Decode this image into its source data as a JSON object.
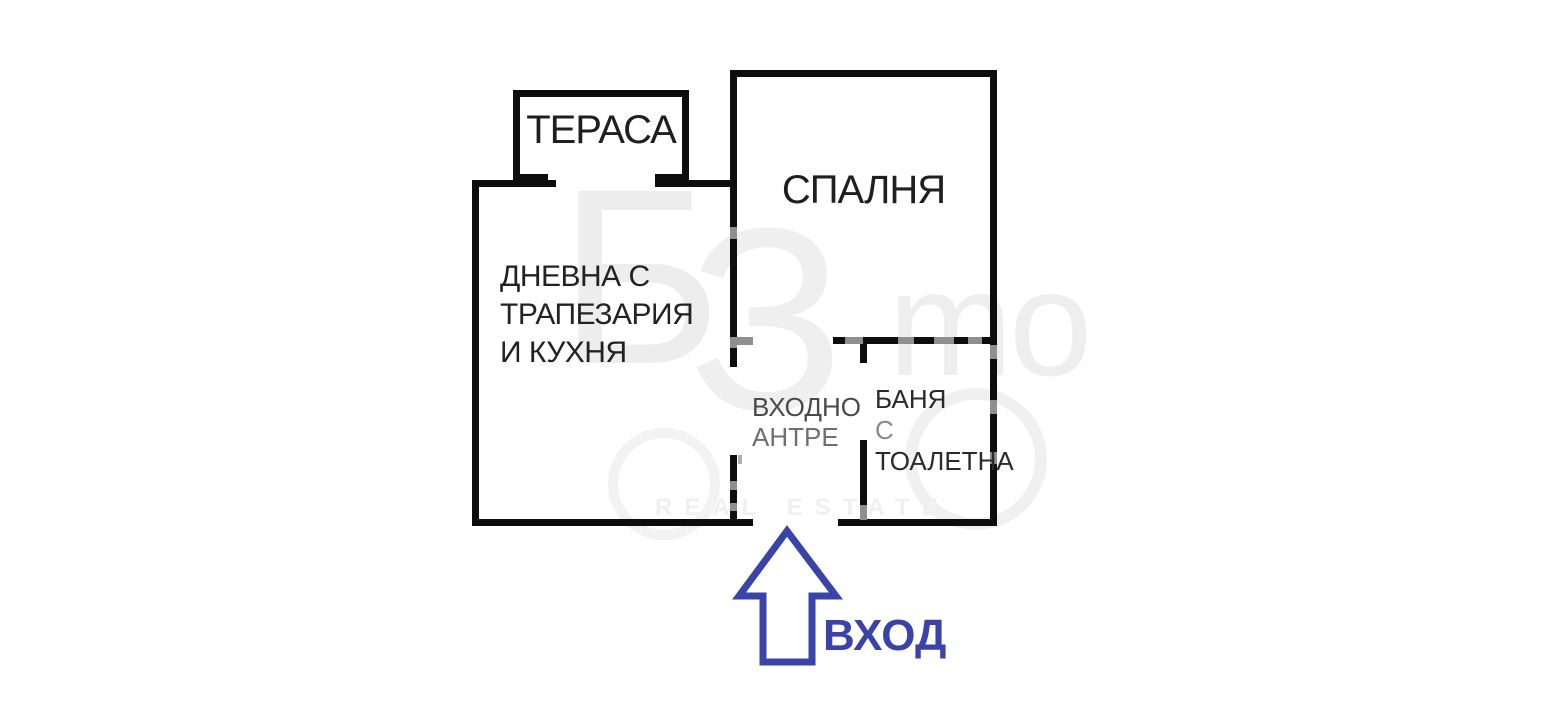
{
  "plan": {
    "rooms": {
      "terrace": {
        "label": "ТЕРАСА"
      },
      "bedroom": {
        "label": "СПАЛНЯ"
      },
      "living": {
        "line1": "ДНЕВНА С",
        "line2": "ТРАПЕЗАРИЯ",
        "line3": "И КУХНЯ"
      },
      "hallway": {
        "line1": "ВХОДНО",
        "line2": "АНТРЕ"
      },
      "bathroom": {
        "line1": "БАНЯ",
        "line2": "С",
        "line3": "ТОАЛЕТНА"
      }
    },
    "entrance": {
      "label": "ВХОД"
    },
    "watermark": {
      "glyph_left": "Б",
      "glyph_mid": "З",
      "glyph_right": "mo",
      "caption": "REAL ESTATE"
    },
    "colors": {
      "wall": "#0d0d0d",
      "entrance_accent": "#3A43A8",
      "watermark_gray": "#ededed"
    }
  }
}
